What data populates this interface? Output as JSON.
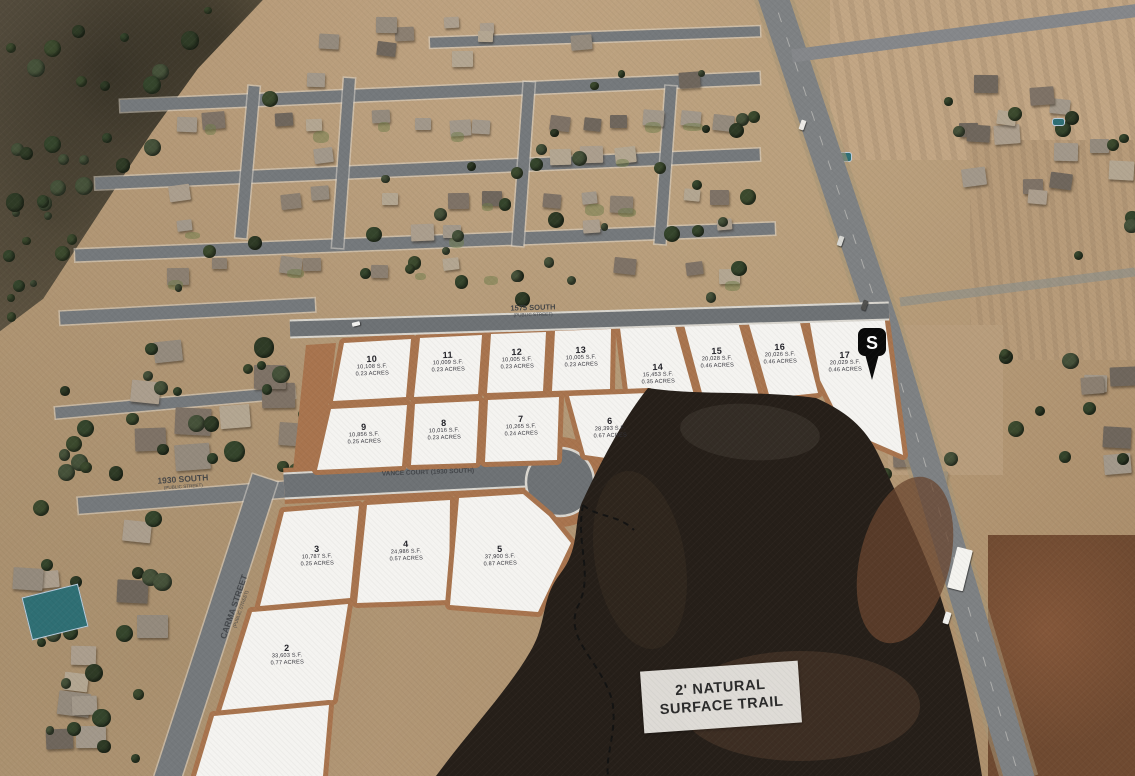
{
  "lots": [
    {
      "number": "10",
      "sf": "10,108 S.F.",
      "acres": "0.23 ACRES"
    },
    {
      "number": "11",
      "sf": "10,009 S.F.",
      "acres": "0.23 ACRES"
    },
    {
      "number": "12",
      "sf": "10,005 S.F.",
      "acres": "0.23 ACRES"
    },
    {
      "number": "13",
      "sf": "10,005 S.F.",
      "acres": "0.23 ACRES"
    },
    {
      "number": "14",
      "sf": "15,453 S.F.",
      "acres": "0.35 ACRES"
    },
    {
      "number": "15",
      "sf": "20,028 S.F.",
      "acres": "0.46 ACRES"
    },
    {
      "number": "16",
      "sf": "20,026 S.F.",
      "acres": "0.46 ACRES"
    },
    {
      "number": "17",
      "sf": "20,029 S.F.",
      "acres": "0.46 ACRES"
    },
    {
      "number": "9",
      "sf": "10,856 S.F.",
      "acres": "0.25 ACRES"
    },
    {
      "number": "8",
      "sf": "10,016 S.F.",
      "acres": "0.23 ACRES"
    },
    {
      "number": "7",
      "sf": "10,265 S.F.",
      "acres": "0.24 ACRES"
    },
    {
      "number": "6",
      "sf": "28,393 S.F.",
      "acres": "0.67 ACRES"
    },
    {
      "number": "3",
      "sf": "10,787 S.F.",
      "acres": "0.25 ACRES"
    },
    {
      "number": "4",
      "sf": "24,986 S.F.",
      "acres": "0.57 ACRES"
    },
    {
      "number": "5",
      "sf": "37,900 S.F.",
      "acres": "0.87 ACRES"
    },
    {
      "number": "2",
      "sf": "33,603 S.F.",
      "acres": "0.77 ACRES"
    }
  ],
  "streets": {
    "top": {
      "name": "1575 SOUTH",
      "sub": "(PUBLIC STREET)"
    },
    "left": {
      "name": "1930 SOUTH",
      "sub": "(PUBLIC STREET)"
    },
    "court": {
      "name": "VANCE COURT (1930 SOUTH)"
    },
    "carma": {
      "name": "CARMA STREET",
      "sub": "(PUBLIC STREET)"
    }
  },
  "trail": {
    "line1": "2' NATURAL",
    "line2": "SURFACE TRAIL"
  },
  "pin": {
    "glyph": "S"
  },
  "colors": {
    "lot_fill": "#f4f3f0",
    "dirt": "#a8744e",
    "hill": "#261f19",
    "road": "#75797c"
  }
}
